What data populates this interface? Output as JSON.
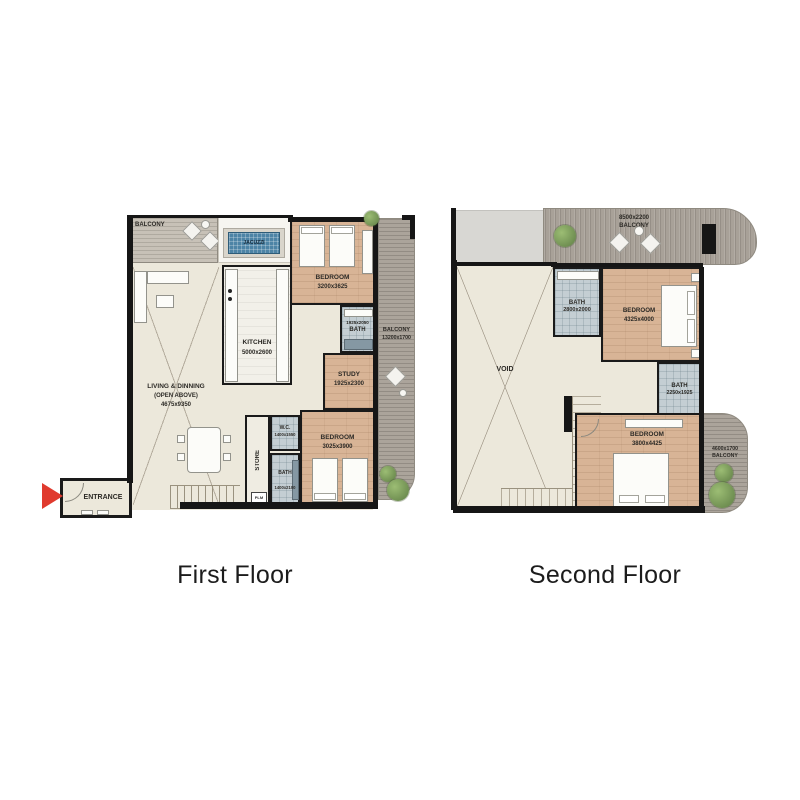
{
  "titles": {
    "first": "First Floor",
    "second": "Second Floor"
  },
  "first_floor": {
    "balcony_top": {
      "label": "BALCONY"
    },
    "jacuzzi": {
      "label": "JACUZZI"
    },
    "bedroom1": {
      "label": "BEDROOM",
      "dims": "3200x3625"
    },
    "balcony_right": {
      "label": "BALCONY",
      "dims": "13200x1700"
    },
    "bath1": {
      "dims": "1925x2050",
      "label": "BATH"
    },
    "study": {
      "label": "STUDY",
      "dims": "1925x2300"
    },
    "bedroom2": {
      "label": "BEDROOM",
      "dims": "3025x3900"
    },
    "wc": {
      "label": "W.C.",
      "dims": "1400x1550"
    },
    "bath2": {
      "label": "BATH",
      "dims": "1400x2100"
    },
    "store": {
      "label": "STORE"
    },
    "kitchen": {
      "label": "KITCHEN",
      "dims": "5000x2600"
    },
    "living": {
      "label": "LIVING & DINNING",
      "sub": "(OPEN ABOVE)",
      "dims": "4675x9350"
    },
    "entrance": {
      "label": "ENTRANCE"
    },
    "plm": {
      "label": "PLM"
    }
  },
  "second_floor": {
    "balcony_top": {
      "dims": "8500x2200",
      "label": "BALCONY"
    },
    "void": {
      "label": "VOID"
    },
    "bath_top": {
      "label": "BATH",
      "dims": "2800x2000"
    },
    "bedroom_top": {
      "label": "BEDROOM",
      "dims": "4325x4000"
    },
    "bath_mid": {
      "label": "BATH",
      "dims": "2250x1925"
    },
    "bedroom_bottom": {
      "label": "BEDROOM",
      "dims": "3800x4425"
    },
    "balcony_right": {
      "dims": "4600x1700",
      "label": "BALCONY"
    }
  },
  "colors": {
    "wall": "#1a1a1a",
    "wood_floor": "#d8b496",
    "cream_floor": "#ece8db",
    "bath_tile": "#c4ced3",
    "deck_gray": "#a8a198",
    "deck_light": "#c7c1b7",
    "jacuzzi_water": "#4d84a6",
    "entrance_arrow": "#e03a2e",
    "plant_green": "#7da257",
    "title_text": "#1c1c1c"
  }
}
